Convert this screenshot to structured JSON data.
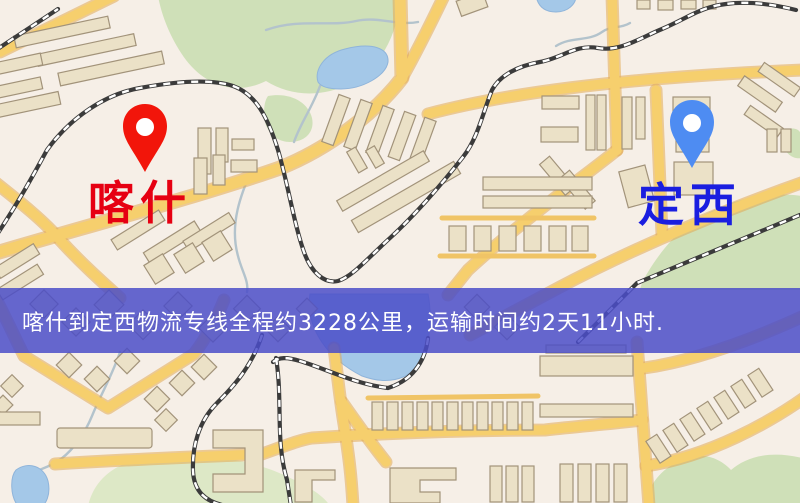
{
  "map": {
    "origin": {
      "label": "喀什",
      "pin": "red-location-pin"
    },
    "destination": {
      "label": "定西",
      "pin": "blue-location-pin"
    }
  },
  "banner": {
    "text": "喀什到定西物流专线全程约3228公里，运输时间约2天11小时.",
    "distance": "约3228公里",
    "duration": "约2天11小时"
  },
  "colors": {
    "background": "#f6efe7",
    "road_yellow": "#f6cf6d",
    "park_green": "#cfe0b8",
    "water_blue": "#a4c8e8",
    "banner_overlay": "#4b4dc8",
    "origin_label_color": "#e60012",
    "destination_label_color": "#1a1ee0",
    "origin_pin_color": "#f2150a",
    "destination_pin_color": "#4e8cf2"
  }
}
